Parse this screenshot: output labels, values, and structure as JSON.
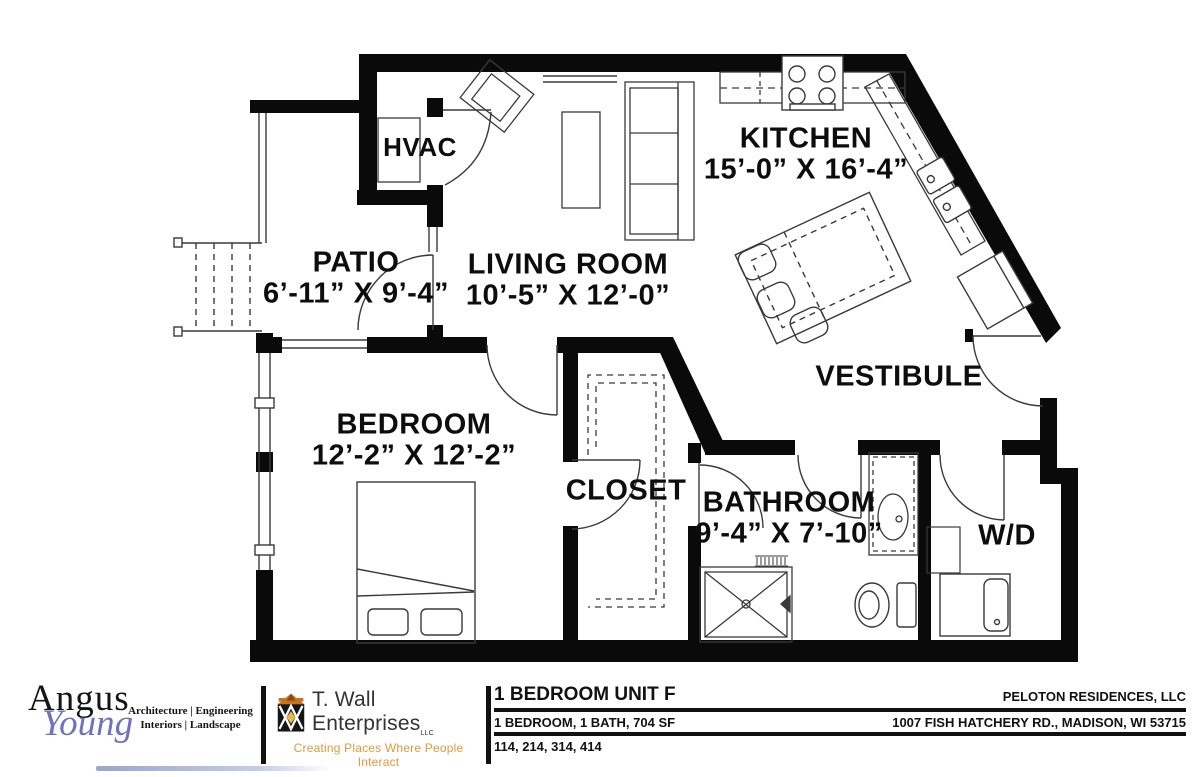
{
  "plan": {
    "rooms": [
      {
        "id": "hvac",
        "label": "HVAC",
        "dims": ""
      },
      {
        "id": "patio",
        "label": "PATIO",
        "dims": "6’-11” X 9’-4”"
      },
      {
        "id": "living",
        "label": "LIVING ROOM",
        "dims": "10’-5” X 12’-0”"
      },
      {
        "id": "kitchen",
        "label": "KITCHEN",
        "dims": "15’-0” X 16’-4”"
      },
      {
        "id": "vestibule",
        "label": "VESTIBULE",
        "dims": ""
      },
      {
        "id": "bedroom",
        "label": "BEDROOM",
        "dims": "12’-2” X 12’-2”"
      },
      {
        "id": "closet",
        "label": "CLOSET",
        "dims": ""
      },
      {
        "id": "bathroom",
        "label": "BATHROOM",
        "dims": "9’-4” X 7’-10”"
      },
      {
        "id": "wd",
        "label": "W/D",
        "dims": ""
      }
    ]
  },
  "footer": {
    "angus": {
      "word1": "Angus",
      "word2": "Young",
      "tag_line1": "Architecture | Engineering",
      "tag_line2": "Interiors | Landscape",
      "accent_color": "#7173b9"
    },
    "twall": {
      "name": "T. Wall Enterprises",
      "suffix": "LLC",
      "tagline": "Creating Places Where People Interact",
      "tagline_color": "#E09A3F",
      "icon": "twall-building-logo-icon"
    },
    "unit": {
      "title": "1 BEDROOM UNIT F",
      "spec": "1 BEDROOM, 1 BATH, 704 SF",
      "unit_numbers": "114, 214, 314, 414"
    },
    "company": {
      "name": "PELOTON RESIDENCES, LLC",
      "address": "1007 FISH HATCHERY RD., MADISON, WI 53715"
    }
  },
  "colors": {
    "walls": "#0a0a0a",
    "thin_lines": "#3a3a3a",
    "label_text": "#0d0d0d"
  }
}
